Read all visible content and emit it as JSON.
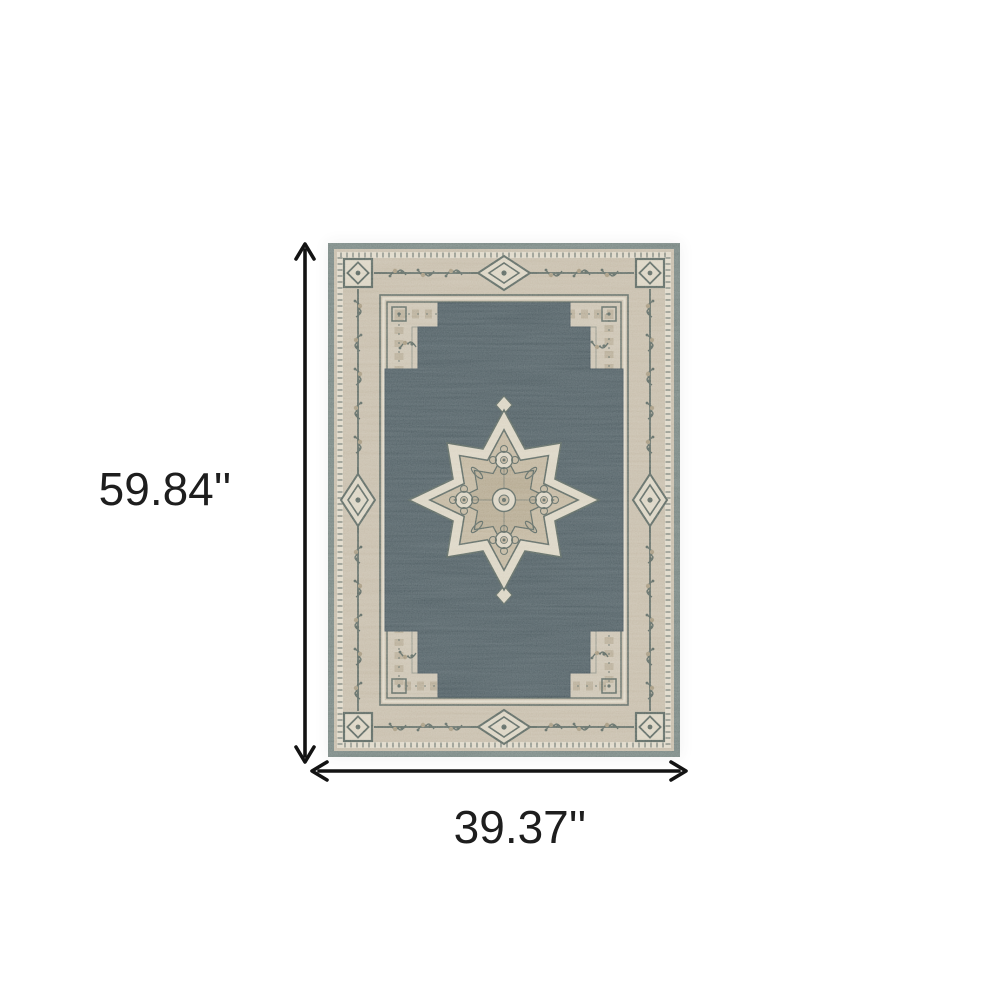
{
  "labels": {
    "height": "59.84''",
    "width": "39.37''"
  },
  "rug": {
    "description": "traditional-oriental-medallion-area-rug",
    "field_style": "dark slate stepped cruciform field with cream scalloped center medallion",
    "border_style": "beige border with corner squares, side diamond medallions and floral sprigs"
  },
  "colors": {
    "background": "#ffffff",
    "arrow": "#131313",
    "label_text": "#1e1e1e",
    "rug_edge": "#75837f",
    "border_beige": "#c4baa7",
    "guard_cream": "#ddd6c5",
    "inner_beige": "#c9c0ae",
    "motif_dark": "#5a665f",
    "motif_tan": "#a3967c",
    "field_dark": "#4f5d62",
    "field_stroke": "#45535a",
    "medallion_cream": "#d9d2c0",
    "medallion_tan": "#bfb39b",
    "medallion_core": "#b2a68d"
  }
}
